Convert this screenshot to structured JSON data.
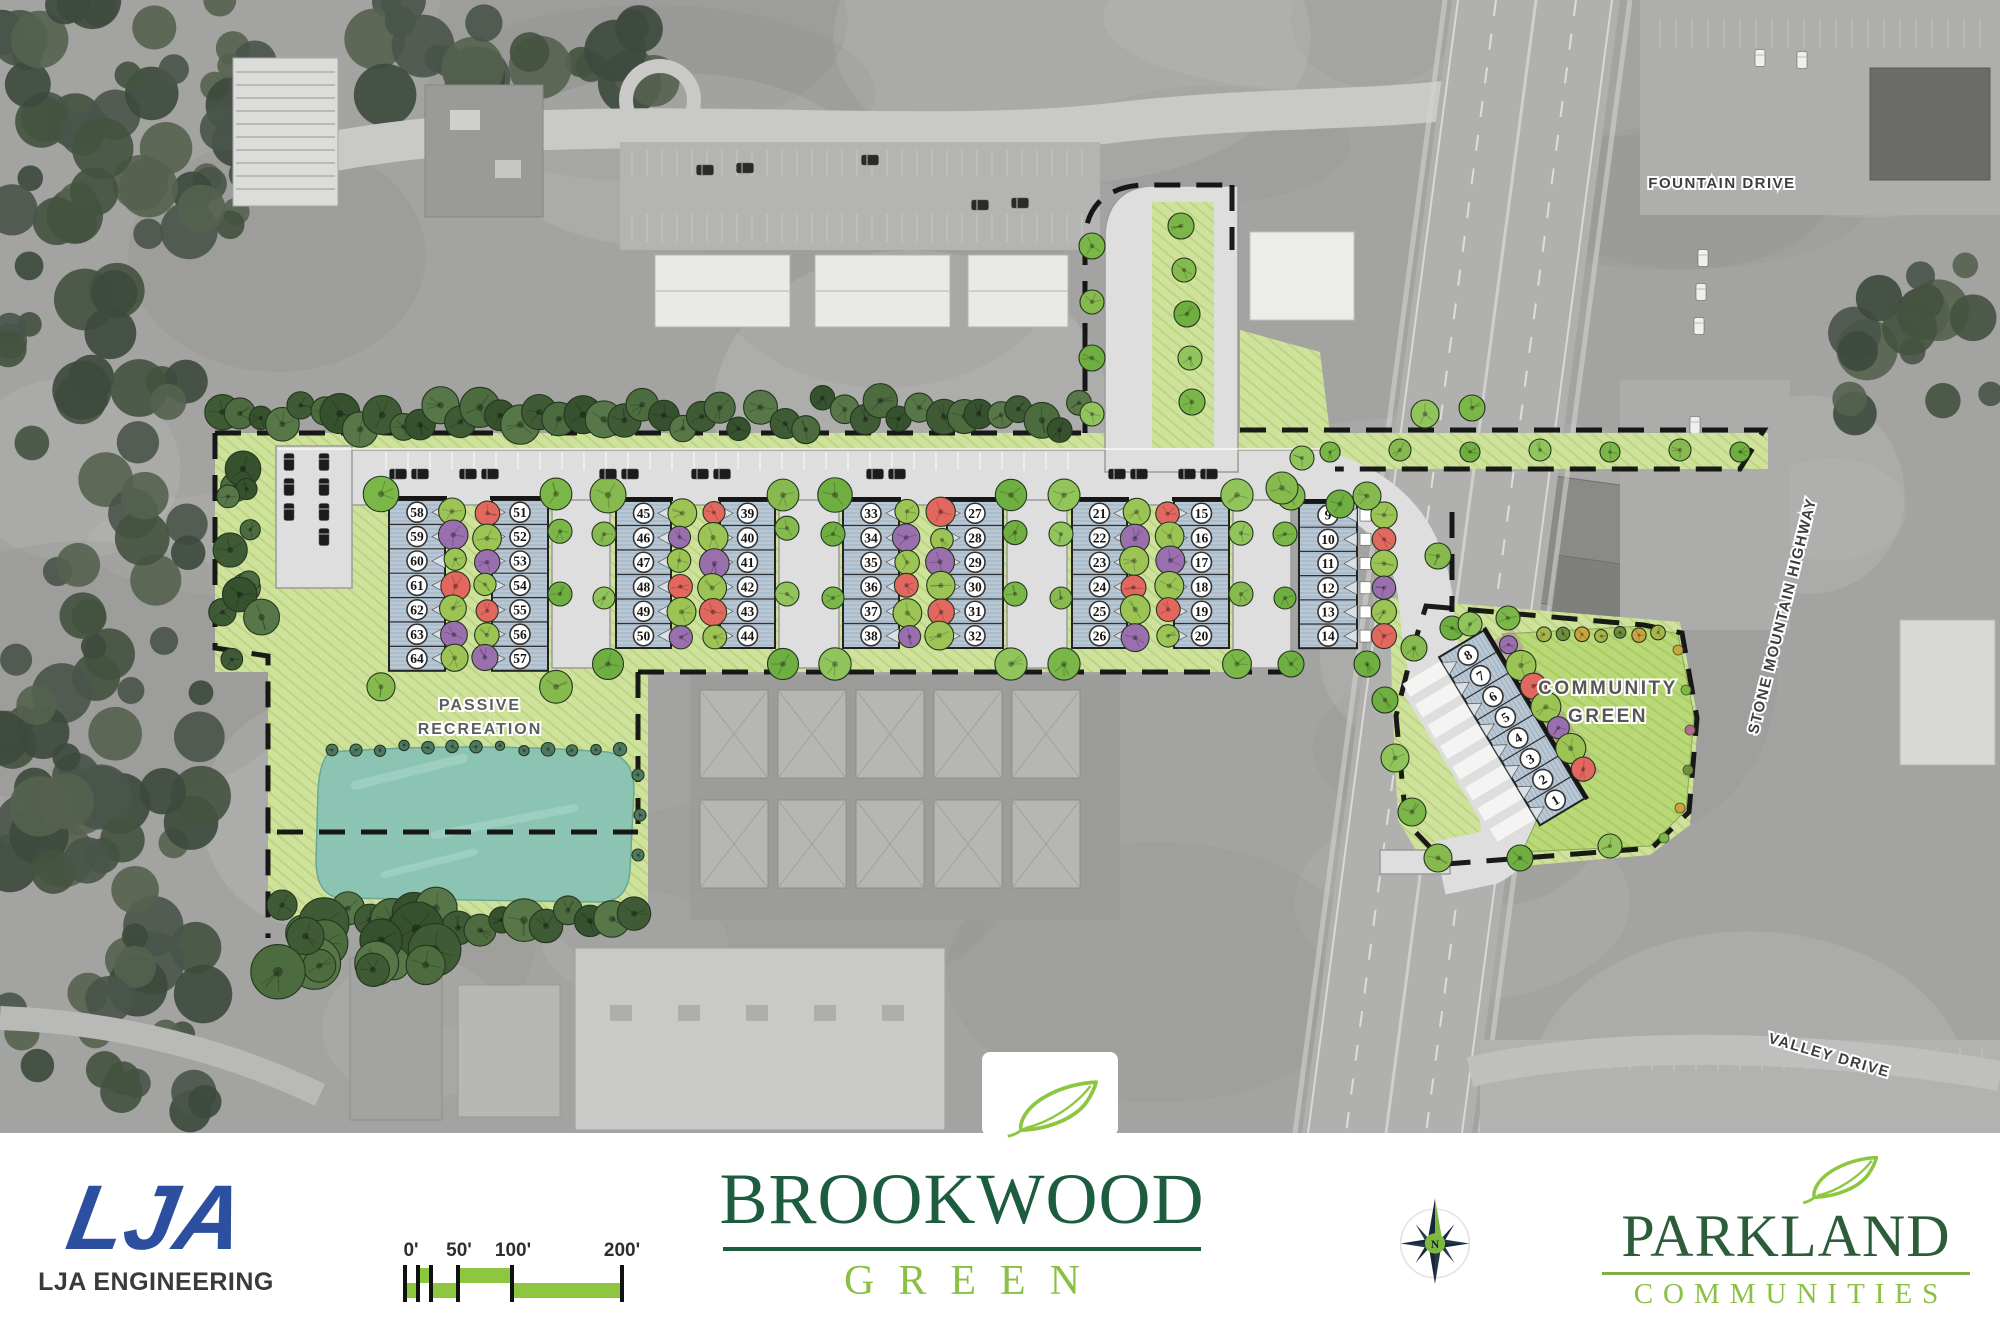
{
  "plan": {
    "labels": {
      "passive_line1": "PASSIVE",
      "passive_line2": "RECREATION",
      "community_line1": "COMMUNITY",
      "community_line2": "GREEN",
      "fountain_drive": "FOUNTAIN DRIVE",
      "stone_mountain_highway": "STONE MOUNTAIN HIGHWAY",
      "valley_drive": "VALLEY DRIVE"
    },
    "compass_label": "N",
    "blocks": [
      {
        "id": "block-1",
        "columns": [
          [
            "58",
            "59",
            "60",
            "61",
            "62",
            "63",
            "64"
          ],
          [
            "51",
            "52",
            "53",
            "54",
            "55",
            "56",
            "57"
          ]
        ]
      },
      {
        "id": "block-2",
        "columns": [
          [
            "45",
            "46",
            "47",
            "48",
            "49",
            "50"
          ],
          [
            "39",
            "40",
            "41",
            "42",
            "43",
            "44"
          ]
        ]
      },
      {
        "id": "block-3",
        "columns": [
          [
            "33",
            "34",
            "35",
            "36",
            "37",
            "38"
          ],
          [
            "27",
            "28",
            "29",
            "30",
            "31",
            "32"
          ]
        ]
      },
      {
        "id": "block-4",
        "columns": [
          [
            "21",
            "22",
            "23",
            "24",
            "25",
            "26"
          ],
          [
            "15",
            "16",
            "17",
            "18",
            "19",
            "20"
          ]
        ]
      },
      {
        "id": "block-5",
        "columns": [
          [
            "9",
            "10",
            "11",
            "12",
            "13",
            "14"
          ]
        ]
      },
      {
        "id": "block-6",
        "columns": [
          [
            "8",
            "7",
            "6",
            "5",
            "4",
            "3",
            "2",
            "1"
          ]
        ]
      }
    ]
  },
  "scale_bar": {
    "labels": [
      "0'",
      "50'",
      "100'",
      "200'"
    ]
  },
  "logos": {
    "lja": {
      "monogram": "LJA",
      "name": "LJA ENGINEERING"
    },
    "brookwood": {
      "title": "BROOKWOOD",
      "subtitle": "GREEN"
    },
    "parkland": {
      "title": "PARKLAND",
      "subtitle": "COMMUNITIES"
    }
  },
  "colors": {
    "accent_green": "#8dc63f",
    "logo_dark_green": "#1d5c3e",
    "parkland_green": "#2c5c3a",
    "light_green_text": "#8ac043",
    "lja_blue": "#2d4f9f",
    "building_fill": "#b9c8d4",
    "lawn": "#cfe29b",
    "community_green": "#b9d877",
    "pond": "#8cc4b4",
    "road": "#dedede",
    "tree_green": "#7ab648",
    "tree_red": "#e2685f",
    "tree_purple": "#9a6fae"
  }
}
